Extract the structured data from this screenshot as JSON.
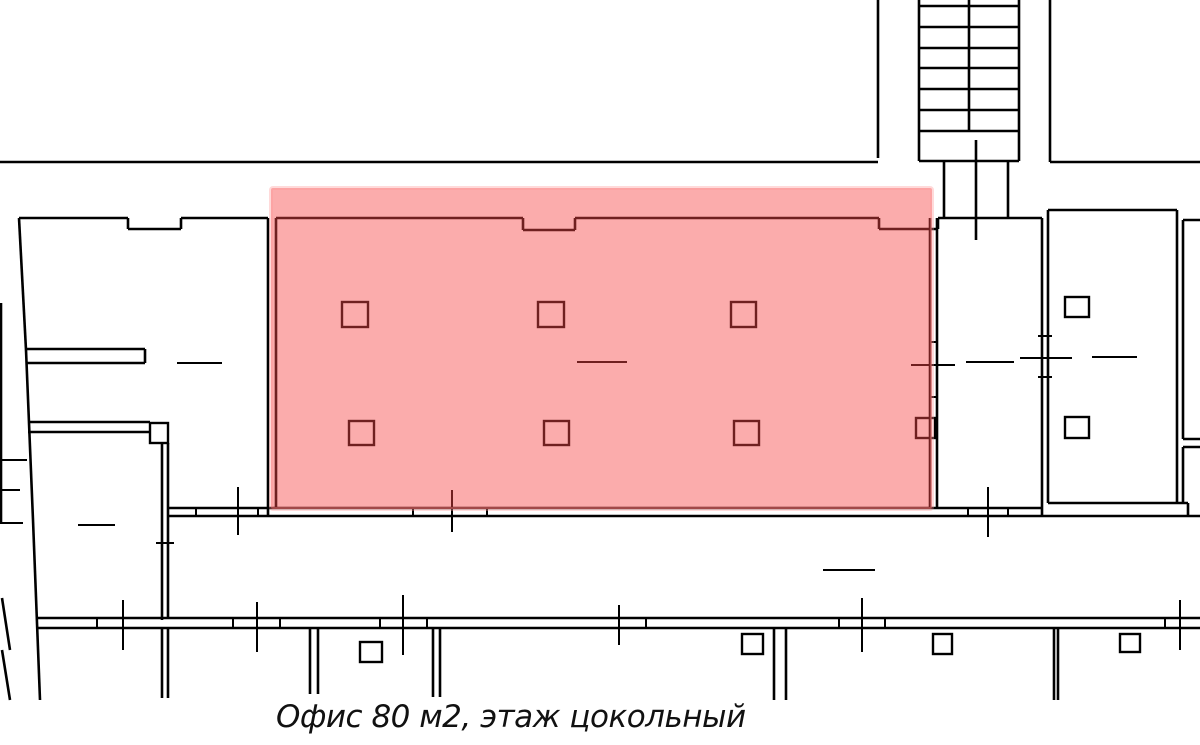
{
  "canvas": {
    "width": 1200,
    "height": 745,
    "background": "#ffffff",
    "line_color": "#000000"
  },
  "caption": {
    "text": "Офис 80 м2, этаж цокольный",
    "office_area": "80 м2",
    "floor": "цокольный",
    "color": "#111111"
  },
  "highlight": {
    "x": 271,
    "y": 188,
    "width": 661,
    "height": 321,
    "fill": "rgba(246,70,70,0.45)",
    "halo": "rgba(255,150,150,0.35)"
  },
  "plan": {
    "wall_stroke_px": 2.6,
    "thin_stroke_px": 2,
    "column_stroke_px": 2.4,
    "stairs": [
      [
        919,
        0,
        919,
        161
      ],
      [
        1019,
        0,
        1019,
        161
      ],
      [
        919,
        161,
        1019,
        161
      ],
      [
        919,
        6,
        1019,
        6
      ],
      [
        919,
        27,
        1019,
        27
      ],
      [
        919,
        48,
        1019,
        48
      ],
      [
        919,
        68,
        1019,
        68
      ],
      [
        919,
        89,
        1019,
        89
      ],
      [
        919,
        110,
        1019,
        110
      ],
      [
        919,
        131,
        1019,
        131
      ],
      [
        969,
        0,
        969,
        131
      ],
      [
        976,
        140,
        976,
        240
      ],
      [
        944,
        161,
        944,
        218
      ],
      [
        1008,
        161,
        1008,
        218
      ]
    ],
    "walls": [
      [
        0,
        162,
        878,
        162
      ],
      [
        878,
        0,
        878,
        158
      ],
      [
        1050,
        0,
        1050,
        162
      ],
      [
        1050,
        162,
        1200,
        162
      ],
      [
        19,
        218,
        128,
        218
      ],
      [
        128,
        218,
        128,
        229
      ],
      [
        128,
        229,
        181,
        229
      ],
      [
        181,
        229,
        181,
        218
      ],
      [
        181,
        218,
        268,
        218
      ],
      [
        276,
        218,
        523,
        218
      ],
      [
        523,
        218,
        523,
        230
      ],
      [
        523,
        230,
        575,
        230
      ],
      [
        575,
        230,
        575,
        218
      ],
      [
        575,
        218,
        879,
        218
      ],
      [
        879,
        218,
        879,
        229
      ],
      [
        879,
        229,
        938,
        229
      ],
      [
        938,
        229,
        938,
        218
      ],
      [
        938,
        218,
        1042,
        218
      ],
      [
        19,
        218,
        26,
        350
      ],
      [
        26,
        350,
        33,
        520
      ],
      [
        33,
        520,
        40,
        700
      ],
      [
        26,
        349,
        145,
        349
      ],
      [
        145,
        349,
        145,
        363
      ],
      [
        26,
        363,
        145,
        363
      ],
      [
        28,
        422,
        150,
        422
      ],
      [
        28,
        432,
        150,
        432
      ],
      [
        162,
        443,
        162,
        620
      ],
      [
        168,
        443,
        168,
        618
      ],
      [
        162,
        628,
        162,
        698
      ],
      [
        168,
        628,
        168,
        698
      ],
      [
        268,
        218,
        268,
        516
      ],
      [
        276,
        218,
        276,
        508
      ],
      [
        930,
        218,
        930,
        508
      ],
      [
        937,
        218,
        937,
        508
      ],
      [
        168,
        508,
        1043,
        508
      ],
      [
        168,
        516,
        1200,
        516
      ],
      [
        1042,
        218,
        1042,
        516
      ],
      [
        1048,
        210,
        1048,
        503
      ],
      [
        1048,
        210,
        1177,
        210
      ],
      [
        1177,
        210,
        1177,
        503
      ],
      [
        1183,
        220,
        1183,
        439
      ],
      [
        1183,
        447,
        1183,
        503
      ],
      [
        1183,
        220,
        1200,
        220
      ],
      [
        1183,
        439,
        1200,
        439
      ],
      [
        1183,
        447,
        1200,
        447
      ],
      [
        1048,
        503,
        1188,
        503
      ],
      [
        1188,
        503,
        1188,
        516
      ],
      [
        38,
        618,
        1200,
        618
      ],
      [
        38,
        628,
        1200,
        628
      ],
      [
        310,
        628,
        310,
        694
      ],
      [
        318,
        628,
        318,
        694
      ],
      [
        433,
        628,
        433,
        697
      ],
      [
        440,
        628,
        440,
        697
      ],
      [
        774,
        628,
        774,
        700
      ],
      [
        786,
        628,
        786,
        700
      ],
      [
        1054,
        628,
        1054,
        700
      ],
      [
        1058,
        628,
        1058,
        700
      ],
      [
        1,
        303,
        1,
        523
      ],
      [
        2,
        598,
        10,
        650
      ],
      [
        2,
        650,
        10,
        700
      ]
    ],
    "marks": [
      [
        196,
        508,
        196,
        516
      ],
      [
        258,
        508,
        258,
        516
      ],
      [
        413,
        508,
        413,
        516
      ],
      [
        487,
        508,
        487,
        516
      ],
      [
        968,
        508,
        968,
        516
      ],
      [
        1008,
        508,
        1008,
        516
      ],
      [
        238,
        487,
        238,
        535
      ],
      [
        452,
        490,
        452,
        532
      ],
      [
        988,
        487,
        988,
        537
      ],
      [
        97,
        618,
        97,
        628
      ],
      [
        233,
        618,
        233,
        628
      ],
      [
        280,
        618,
        280,
        628
      ],
      [
        380,
        618,
        380,
        628
      ],
      [
        427,
        618,
        427,
        628
      ],
      [
        646,
        618,
        646,
        628
      ],
      [
        839,
        618,
        839,
        628
      ],
      [
        885,
        618,
        885,
        628
      ],
      [
        1165,
        618,
        1165,
        628
      ],
      [
        123,
        600,
        123,
        650
      ],
      [
        257,
        602,
        257,
        652
      ],
      [
        403,
        595,
        403,
        655
      ],
      [
        619,
        605,
        619,
        645
      ],
      [
        862,
        598,
        862,
        652
      ],
      [
        1180,
        600,
        1180,
        650
      ],
      [
        930,
        342,
        937,
        342
      ],
      [
        930,
        397,
        937,
        397
      ],
      [
        911,
        365,
        955,
        365
      ],
      [
        966,
        362,
        1014,
        362
      ],
      [
        1020,
        358,
        1072,
        358
      ],
      [
        1092,
        357,
        1137,
        357
      ],
      [
        577,
        362,
        627,
        362
      ],
      [
        823,
        570,
        875,
        570
      ],
      [
        177,
        363,
        222,
        363
      ],
      [
        78,
        525,
        115,
        525
      ],
      [
        1038,
        336,
        1052,
        336
      ],
      [
        1038,
        377,
        1052,
        377
      ],
      [
        156,
        543,
        174,
        543
      ],
      [
        0,
        460,
        27,
        460
      ],
      [
        0,
        490,
        20,
        490
      ],
      [
        0,
        523,
        23,
        523
      ]
    ],
    "columns": [
      [
        342,
        302,
        26,
        25
      ],
      [
        538,
        302,
        26,
        25
      ],
      [
        731,
        302,
        25,
        25
      ],
      [
        349,
        421,
        25,
        24
      ],
      [
        544,
        421,
        25,
        24
      ],
      [
        734,
        421,
        25,
        24
      ],
      [
        916,
        418,
        19,
        20
      ],
      [
        1065,
        297,
        24,
        20
      ],
      [
        1065,
        417,
        24,
        21
      ],
      [
        360,
        642,
        22,
        20
      ],
      [
        742,
        634,
        21,
        20
      ],
      [
        933,
        634,
        19,
        20
      ],
      [
        1120,
        634,
        20,
        18
      ],
      [
        150,
        423,
        18,
        20
      ]
    ]
  }
}
